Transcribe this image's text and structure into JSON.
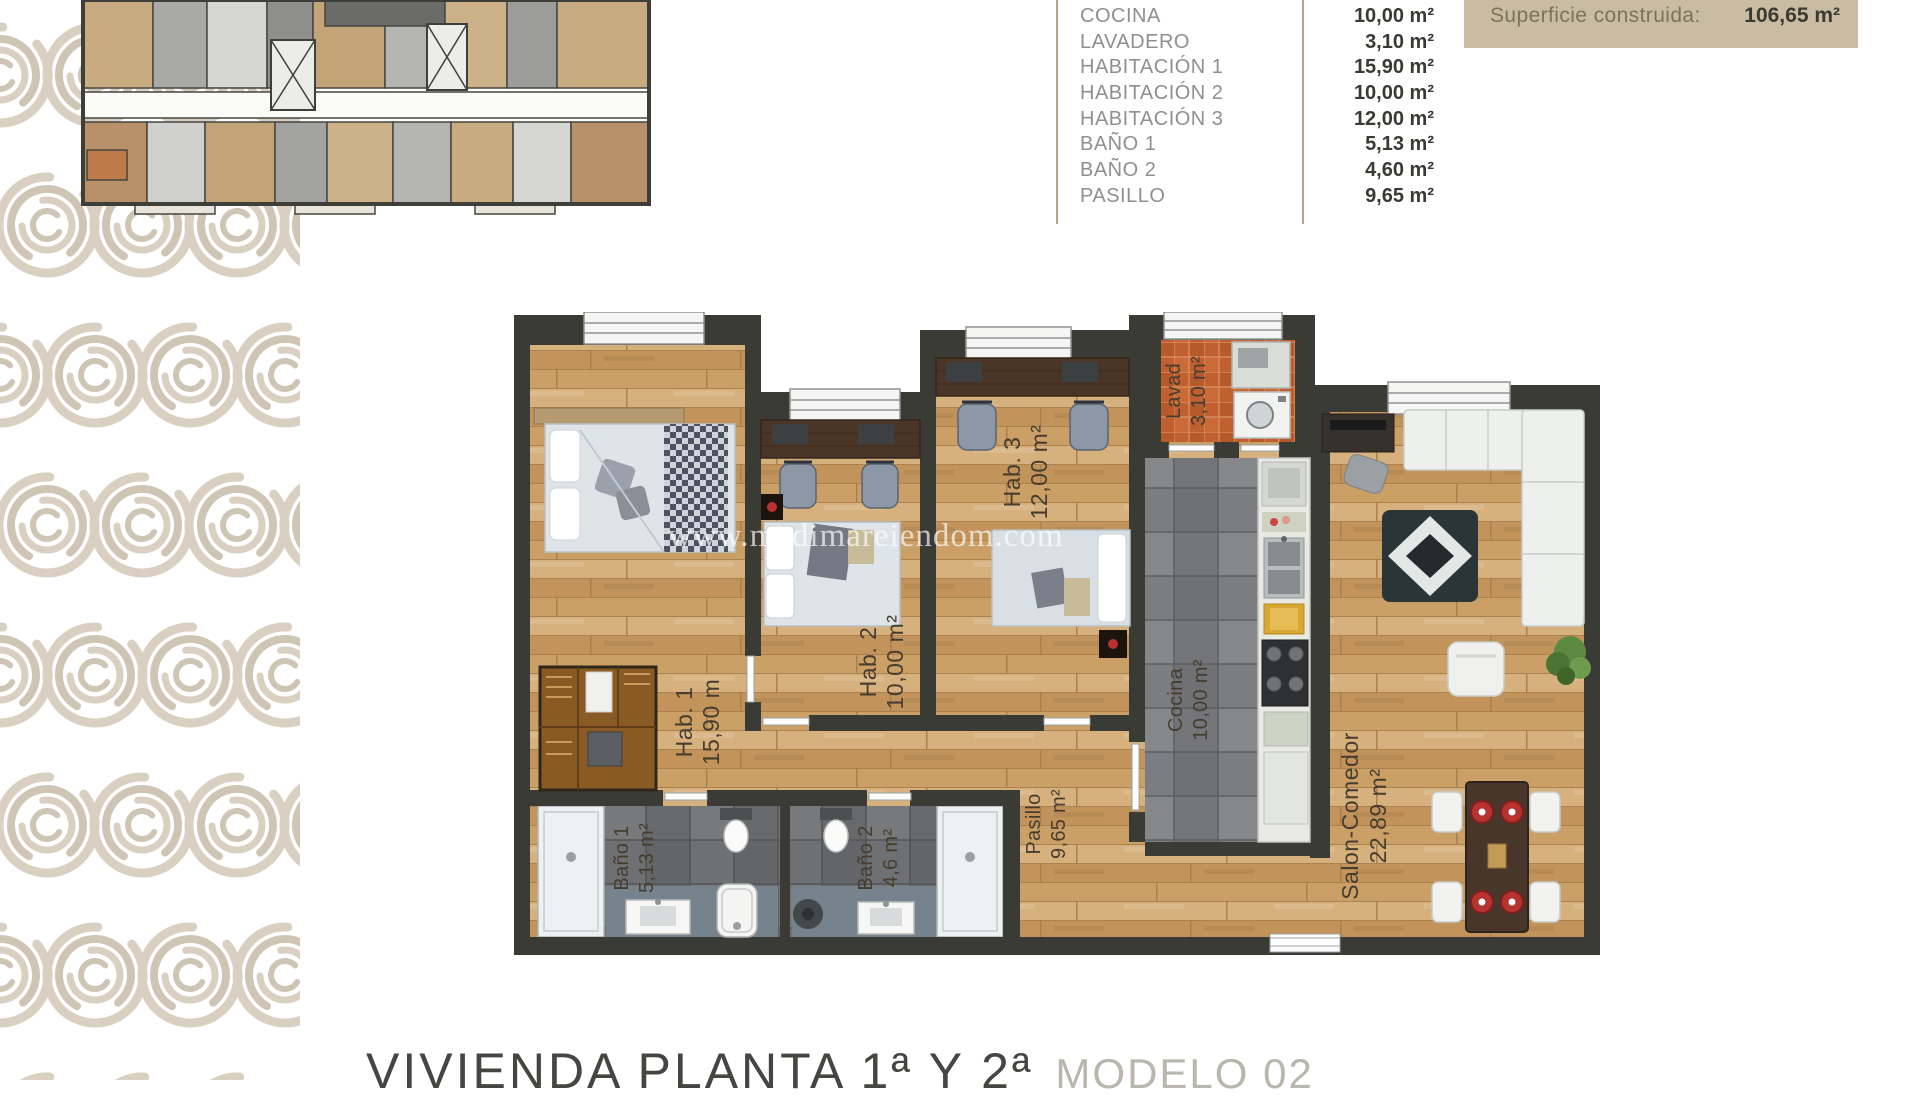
{
  "document": {
    "watermark": "www.medimareiendom.com",
    "footer": {
      "title": "VIVIENDA PLANTA 1ª Y 2ª",
      "model": "MODELO 02"
    }
  },
  "summary_table": {
    "rows": [
      {
        "name": "SALON-COMEDOR",
        "area": "22,89 m²"
      },
      {
        "name": "COCINA",
        "area": "10,00 m²"
      },
      {
        "name": "LAVADERO",
        "area": "3,10 m²"
      },
      {
        "name": "HABITACIÓN 1",
        "area": "15,90 m²"
      },
      {
        "name": "HABITACIÓN 2",
        "area": "10,00 m²"
      },
      {
        "name": "HABITACIÓN 3",
        "area": "12,00 m²"
      },
      {
        "name": "BAÑO 1",
        "area": "5,13 m²"
      },
      {
        "name": "BAÑO 2",
        "area": "4,60 m²"
      },
      {
        "name": "PASILLO",
        "area": "9,65 m²"
      }
    ]
  },
  "superficie": {
    "label": "Superficie construida:",
    "value": "106,65 m²"
  },
  "floorplan": {
    "rooms": [
      {
        "id": "hab1",
        "line1": "Hab. 1",
        "line2": "15,90 m"
      },
      {
        "id": "hab2",
        "line1": "Hab. 2",
        "line2": "10,00 m²"
      },
      {
        "id": "hab3",
        "line1": "Hab. 3",
        "line2": "12,00 m²"
      },
      {
        "id": "lavadero",
        "line1": "Lavad",
        "line2": "3,10 m²"
      },
      {
        "id": "cocina",
        "line1": "Cocina",
        "line2": "10,00 m²"
      },
      {
        "id": "pasillo",
        "line1": "Pasillo",
        "line2": "9,65 m²"
      },
      {
        "id": "bano1",
        "line1": "Baño 1",
        "line2": "5,13 m²"
      },
      {
        "id": "bano2",
        "line1": "Baño 2",
        "line2": "4,6 m²"
      },
      {
        "id": "salon",
        "line1": "Salon-Comedor",
        "line2": "22,89 m²"
      }
    ]
  },
  "colors": {
    "wall": "#3a3b35",
    "wood": "#cda671",
    "tile_gray": "#75777a",
    "tile_orange": "#c06030",
    "accent_tan": "#c9bca2",
    "rule": "#b5a78c"
  }
}
